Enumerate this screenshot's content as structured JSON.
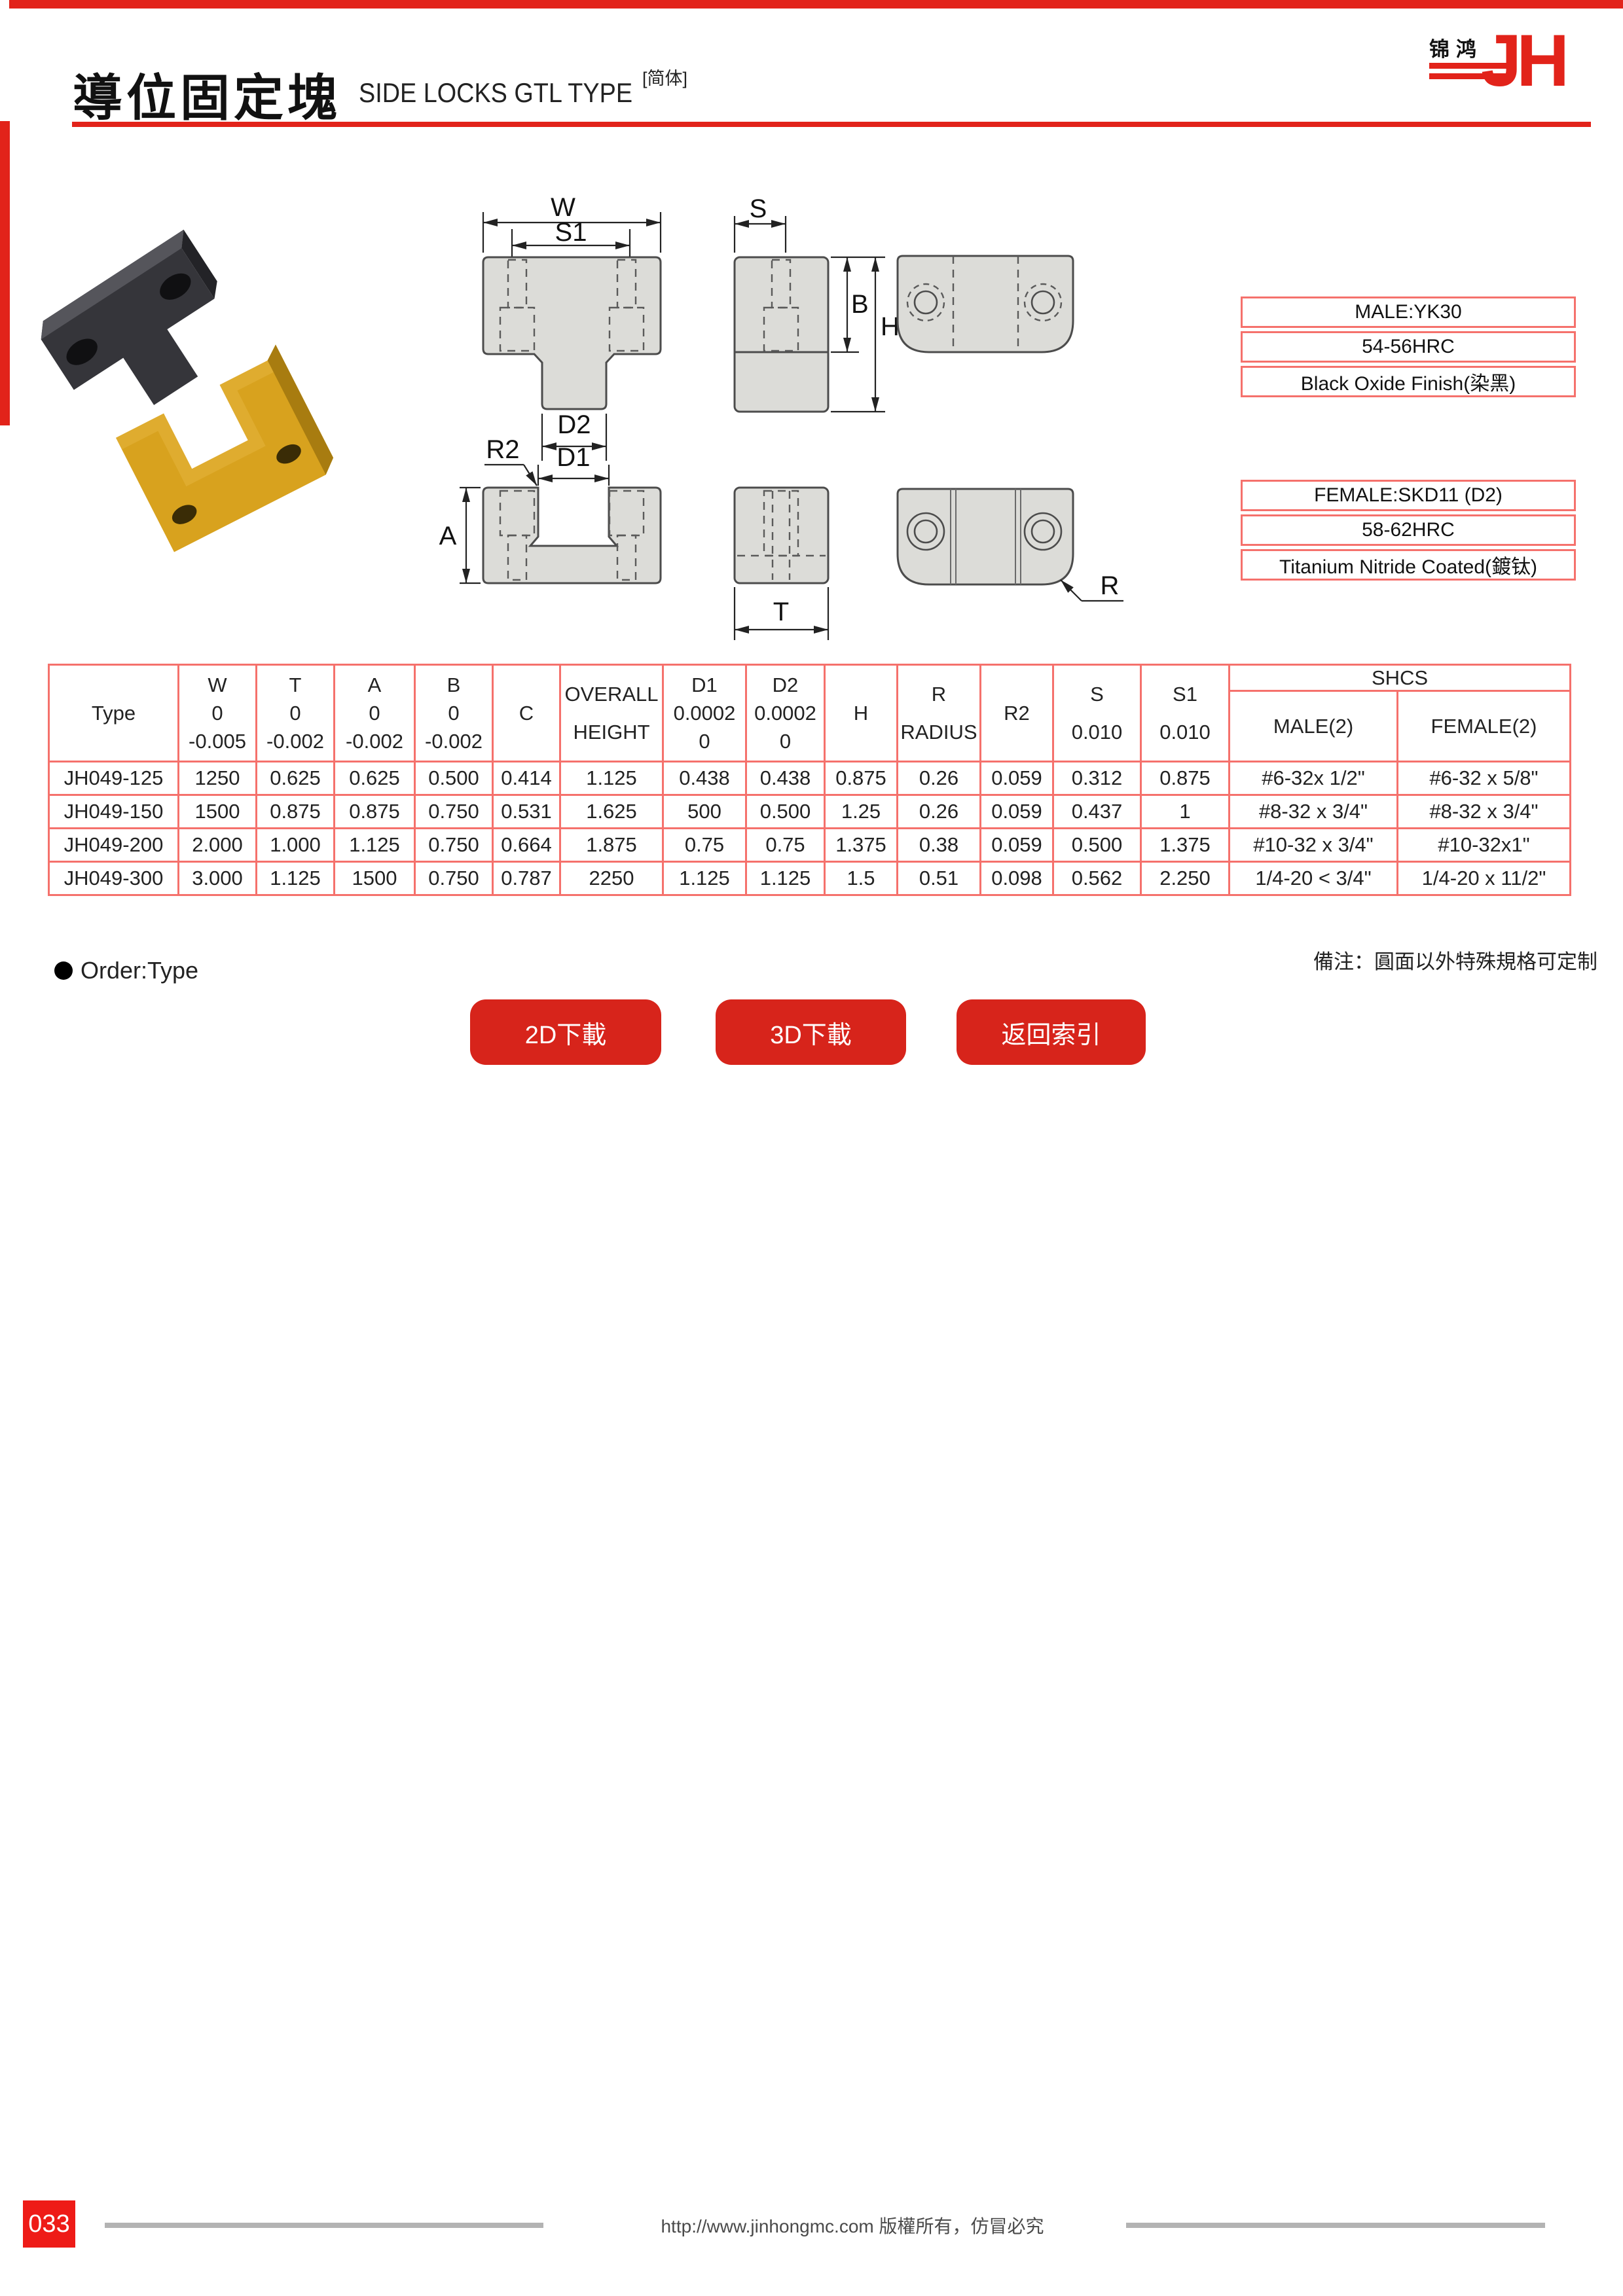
{
  "header": {
    "title_cn": "導位固定塊",
    "title_en": "SIDE LOCKS GTL TYPE",
    "edition": "[简体]",
    "logo_cn": "锦鸿",
    "logo_mark": "JH",
    "accent_red": "#e2231a"
  },
  "specs": {
    "male": [
      "MALE:YK30",
      "54-56HRC",
      "Black Oxide Finish(染黑)"
    ],
    "female": [
      "FEMALE:SKD11 (D2)",
      "58-62HRC",
      "Titanium Nitride Coated(鍍钛)"
    ]
  },
  "drawing": {
    "labels": {
      "w": "W",
      "s1": "S1",
      "d2": "D2",
      "r2": "R2",
      "d1": "D1",
      "a": "A",
      "s": "S",
      "b": "B",
      "h": "H",
      "t": "T",
      "r": "R"
    }
  },
  "table": {
    "border_color": "#f5716c",
    "shcs": "SHCS",
    "columns": [
      {
        "line1": "Type"
      },
      {
        "line1": "W",
        "line2": "0",
        "line3": "-0.005"
      },
      {
        "line1": "T",
        "line2": "0",
        "line3": "-0.002"
      },
      {
        "line1": "A",
        "line2": "0",
        "line3": "-0.002"
      },
      {
        "line1": "B",
        "line2": "0",
        "line3": "-0.002"
      },
      {
        "line1": "C"
      },
      {
        "line1": "OVERALL",
        "line2": "HEIGHT"
      },
      {
        "line1": "D1",
        "line2": "0.0002",
        "line3": "0"
      },
      {
        "line1": "D2",
        "line2": "0.0002",
        "line3": "0"
      },
      {
        "line1": "H"
      },
      {
        "line1": "R",
        "line2": "RADIUS"
      },
      {
        "line1": "R2"
      },
      {
        "line1": "S",
        "line2": "0.010"
      },
      {
        "line1": "S1",
        "line2": "0.010"
      },
      {
        "line1": "MALE(2)"
      },
      {
        "line1": "FEMALE(2)"
      }
    ],
    "rows": [
      [
        "JH049-125",
        "1250",
        "0.625",
        "0.625",
        "0.500",
        "0.414",
        "1.125",
        "0.438",
        "0.438",
        "0.875",
        "0.26",
        "0.059",
        "0.312",
        "0.875",
        "#6-32x 1/2\"",
        "#6-32 x 5/8\""
      ],
      [
        "JH049-150",
        "1500",
        "0.875",
        "0.875",
        "0.750",
        "0.531",
        "1.625",
        "500",
        "0.500",
        "1.25",
        "0.26",
        "0.059",
        "0.437",
        "1",
        "#8-32 x 3/4\"",
        "#8-32 x 3/4\""
      ],
      [
        "JH049-200",
        "2.000",
        "1.000",
        "1.125",
        "0.750",
        "0.664",
        "1.875",
        "0.75",
        "0.75",
        "1.375",
        "0.38",
        "0.059",
        "0.500",
        "1.375",
        "#10-32 x 3/4\"",
        "#10-32x1\""
      ],
      [
        "JH049-300",
        "3.000",
        "1.125",
        "1500",
        "0.750",
        "0.787",
        "2250",
        "1.125",
        "1.125",
        "1.5",
        "0.51",
        "0.098",
        "0.562",
        "2.250",
        "1/4-20 < 3/4\"",
        "1/4-20 x 11/2\""
      ]
    ]
  },
  "order_note": "Order:Type",
  "remark": "備注：圓面以外特殊規格可定制",
  "buttons": [
    {
      "label": "2D下載"
    },
    {
      "label": "3D下載"
    },
    {
      "label": "返回索引"
    }
  ],
  "footer": {
    "copyright": "http://www.jinhongmc.com 版權所有，仿冒必究",
    "page_number": "033"
  }
}
